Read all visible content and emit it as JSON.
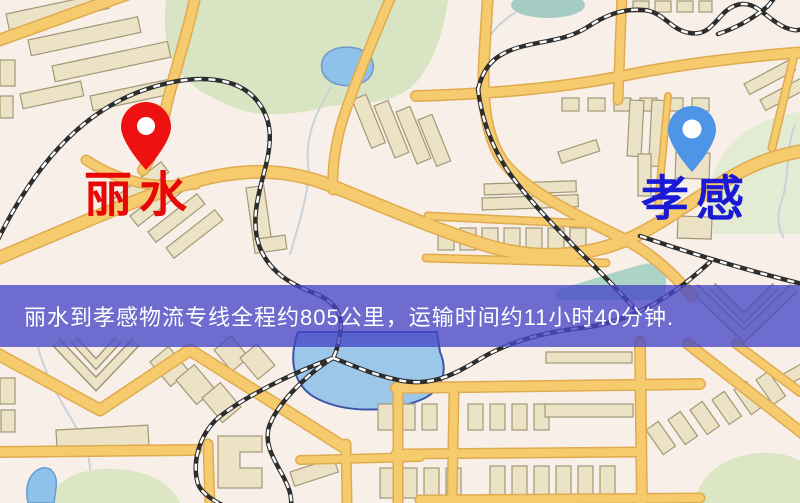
{
  "banner": {
    "text": "丽水到孝感物流专线全程约805公里，运输时间约11小时40分钟.",
    "background_color": "#4646c6",
    "text_color": "#ffffff"
  },
  "route": {
    "origin": "丽水",
    "destination": "孝感",
    "distance": "约805公里",
    "duration": "约11小时40分钟"
  },
  "map": {
    "origin_marker": {
      "label": "丽水",
      "pin_color": "#ee1111",
      "label_color": "#e80707"
    },
    "destination_marker": {
      "label": "孝感",
      "pin_color": "#4e95e8",
      "label_color": "#1a1ad6"
    },
    "palette": {
      "background": "#f8f0e8",
      "road": "#f5cb6e",
      "road_casing": "#e0ab50",
      "building": "#ece3c6",
      "building_outline": "#a29877",
      "park": "#d9e4c2",
      "water": "#8fc2ea",
      "railway": "#2d2d2d"
    }
  }
}
